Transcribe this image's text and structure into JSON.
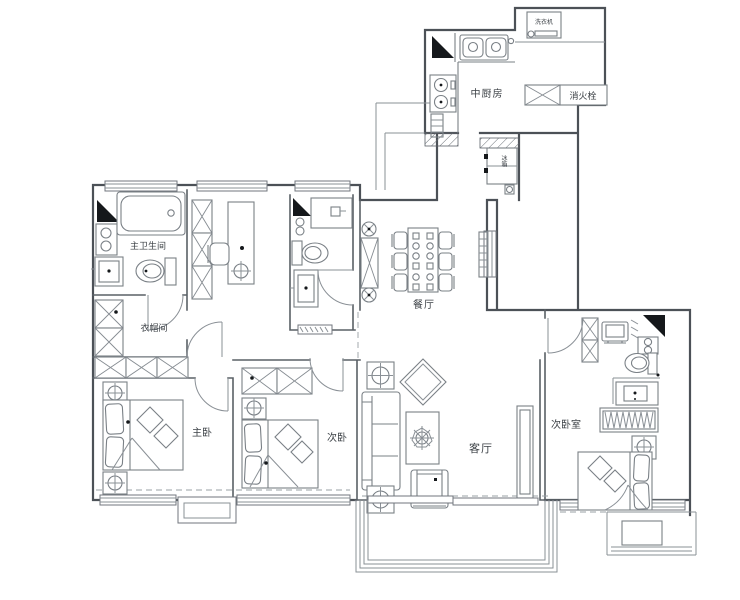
{
  "plan": {
    "type": "apartment-floor-plan",
    "language": "zh-CN"
  },
  "rooms": {
    "kitchen": {
      "label": "中厨房"
    },
    "master_bathroom": {
      "label": "主卫生间"
    },
    "cloakroom": {
      "label": "衣帽间"
    },
    "dining_room": {
      "label": "餐厅"
    },
    "master_bedroom": {
      "label": "主卧"
    },
    "second_bedroom": {
      "label": "次卧"
    },
    "living_room": {
      "label": "客厅"
    },
    "guest_bedroom": {
      "label": "次卧室"
    }
  },
  "fixtures": {
    "fire_hydrant": {
      "label": "消火栓"
    },
    "washing_machine": {
      "label": "洗衣机"
    },
    "refrigerator": {
      "label": "冰箱"
    }
  },
  "colors": {
    "wall": "#4c5157",
    "furniture": "#7a8086",
    "marker": "#15181b",
    "label_text": "#3c4146",
    "background": "#ffffff"
  }
}
